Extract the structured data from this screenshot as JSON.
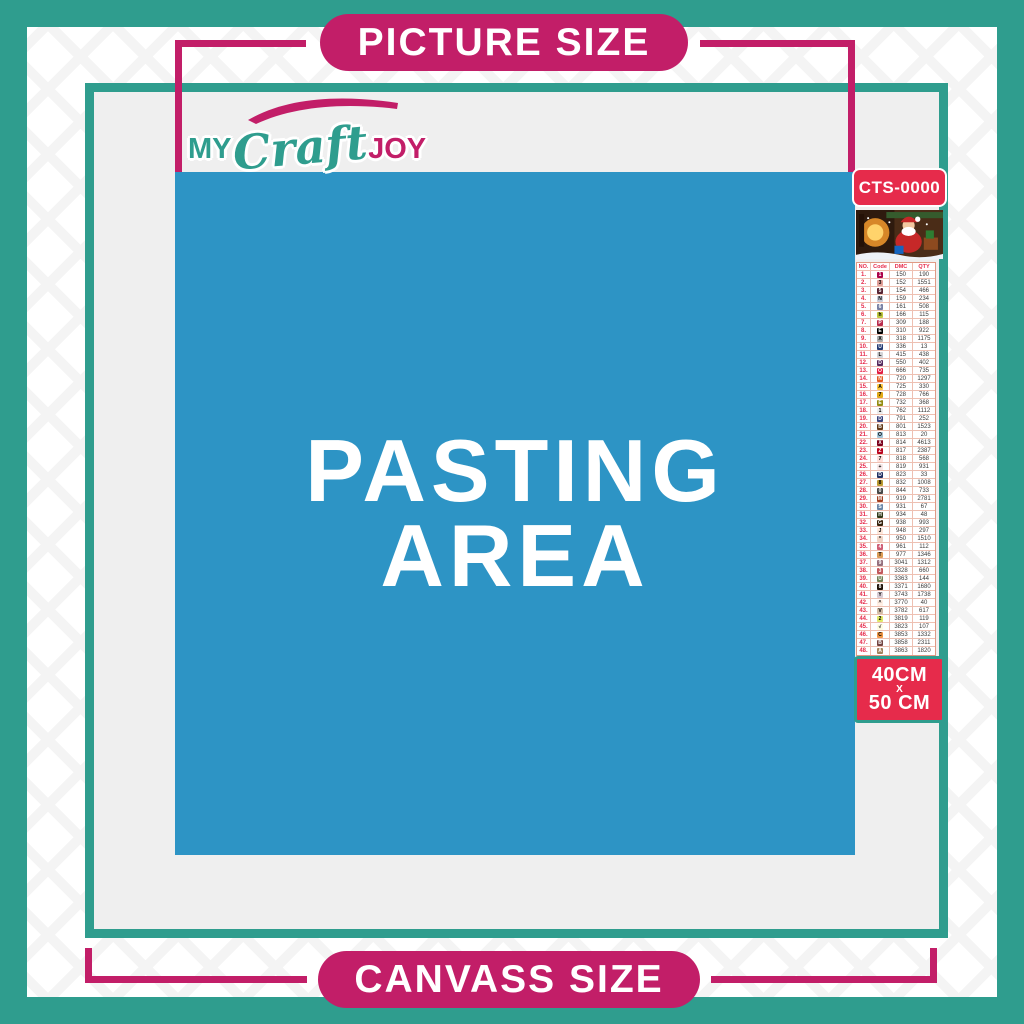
{
  "colors": {
    "teal": "#2F9D8E",
    "pink": "#C21E68",
    "red": "#E62B4B",
    "blue": "#2D94C5",
    "gray": "#EFEFEF"
  },
  "top_banner": {
    "label": "PICTURE SIZE"
  },
  "bottom_banner": {
    "label": "CANVASS SIZE"
  },
  "logo": {
    "my": "MY",
    "craft": "Craft",
    "joy": "JOY"
  },
  "pasting": {
    "line1": "PASTING",
    "line2": "AREA"
  },
  "sidebar": {
    "product_code": "CTS-0000",
    "size_box": {
      "width": "40CM",
      "sep": "X",
      "height": "50 CM"
    },
    "table": {
      "headers": [
        "NO.",
        "Code",
        "DMC",
        "QTY"
      ],
      "rows": [
        [
          "1.",
          "1",
          "#AB0249",
          "#fff",
          "150",
          "190"
        ],
        [
          "2.",
          "3",
          "#E2A099",
          "#000",
          "152",
          "1551"
        ],
        [
          "3.",
          "5",
          "#572433",
          "#fff",
          "154",
          "466"
        ],
        [
          "4.",
          "N",
          "#C7CAD7",
          "#000",
          "159",
          "234"
        ],
        [
          "5.",
          "6",
          "#7880A4",
          "#fff",
          "161",
          "508"
        ],
        [
          "6.",
          "h",
          "#C0C840",
          "#000",
          "166",
          "115"
        ],
        [
          "7.",
          "P",
          "#BA2C4C",
          "#fff",
          "309",
          "188"
        ],
        [
          "8.",
          "E",
          "#000000",
          "#fff",
          "310",
          "922"
        ],
        [
          "9.",
          "X",
          "#ABABAB",
          "#000",
          "318",
          "1175"
        ],
        [
          "10.",
          "U",
          "#253B73",
          "#fff",
          "336",
          "13"
        ],
        [
          "11.",
          "L",
          "#D3D3D6",
          "#000",
          "415",
          "438"
        ],
        [
          "12.",
          "D",
          "#55285C",
          "#fff",
          "550",
          "402"
        ],
        [
          "13.",
          "O",
          "#E31D42",
          "#fff",
          "666",
          "735"
        ],
        [
          "14.",
          "N",
          "#E55C1F",
          "#fff",
          "720",
          "1297"
        ],
        [
          "15.",
          "A",
          "#FFC840",
          "#000",
          "725",
          "330"
        ],
        [
          "16.",
          "7",
          "#E2A918",
          "#000",
          "728",
          "766"
        ],
        [
          "17.",
          "E",
          "#948C10",
          "#fff",
          "732",
          "368"
        ],
        [
          "18.",
          "1",
          "#ECECEC",
          "#000",
          "762",
          "1112"
        ],
        [
          "19.",
          "D",
          "#39427C",
          "#fff",
          "791",
          "252"
        ],
        [
          "20.",
          "B",
          "#653919",
          "#fff",
          "801",
          "1523"
        ],
        [
          "21.",
          "O",
          "#A1C2D7",
          "#000",
          "813",
          "20"
        ],
        [
          "22.",
          "X",
          "#7B001B",
          "#fff",
          "814",
          "4613"
        ],
        [
          "23.",
          "Z",
          "#BB051F",
          "#fff",
          "817",
          "2387"
        ],
        [
          "24.",
          "7",
          "#FFDFD9",
          "#000",
          "818",
          "568"
        ],
        [
          "25.",
          "+",
          "#F8E8E7",
          "#000",
          "819",
          "931"
        ],
        [
          "26.",
          "D",
          "#213063",
          "#fff",
          "823",
          "33"
        ],
        [
          "27.",
          "8",
          "#BD9B33",
          "#000",
          "832",
          "1008"
        ],
        [
          "28.",
          "0",
          "#484848",
          "#fff",
          "844",
          "733"
        ],
        [
          "29.",
          "M",
          "#A34021",
          "#fff",
          "919",
          "2781"
        ],
        [
          "30.",
          "S",
          "#6A86A8",
          "#fff",
          "931",
          "67"
        ],
        [
          "31.",
          "H",
          "#313919",
          "#fff",
          "934",
          "48"
        ],
        [
          "32.",
          "G",
          "#36220C",
          "#fff",
          "938",
          "993"
        ],
        [
          "33.",
          "J",
          "#FEE7DA",
          "#000",
          "948",
          "297"
        ],
        [
          "34.",
          "*",
          "#EED3C4",
          "#000",
          "950",
          "1510"
        ],
        [
          "35.",
          "4",
          "#CF5D74",
          "#fff",
          "961",
          "112"
        ],
        [
          "36.",
          "T",
          "#DC9C56",
          "#000",
          "977",
          "1346"
        ],
        [
          "37.",
          "9",
          "#956F7C",
          "#fff",
          "3041",
          "1312"
        ],
        [
          "38.",
          "3",
          "#C1575C",
          "#fff",
          "3328",
          "660"
        ],
        [
          "39.",
          "U",
          "#728256",
          "#fff",
          "3363",
          "144"
        ],
        [
          "40.",
          "8",
          "#1E1108",
          "#fff",
          "3371",
          "1680"
        ],
        [
          "41.",
          "Y",
          "#D7CBD3",
          "#000",
          "3743",
          "1738"
        ],
        [
          "42.",
          "^",
          "#FFEEE3",
          "#000",
          "3770",
          "40"
        ],
        [
          "43.",
          "V",
          "#D2BCA6",
          "#000",
          "3782",
          "617"
        ],
        [
          "44.",
          "2",
          "#E0E868",
          "#000",
          "3819",
          "119"
        ],
        [
          "45.",
          "√",
          "#FFFDE3",
          "#000",
          "3823",
          "107"
        ],
        [
          "46.",
          "C",
          "#F29746",
          "#000",
          "3853",
          "1332"
        ],
        [
          "47.",
          "B",
          "#744541",
          "#fff",
          "3858",
          "2311"
        ],
        [
          "48.",
          "A",
          "#A4835C",
          "#fff",
          "3863",
          "1820"
        ]
      ]
    }
  }
}
